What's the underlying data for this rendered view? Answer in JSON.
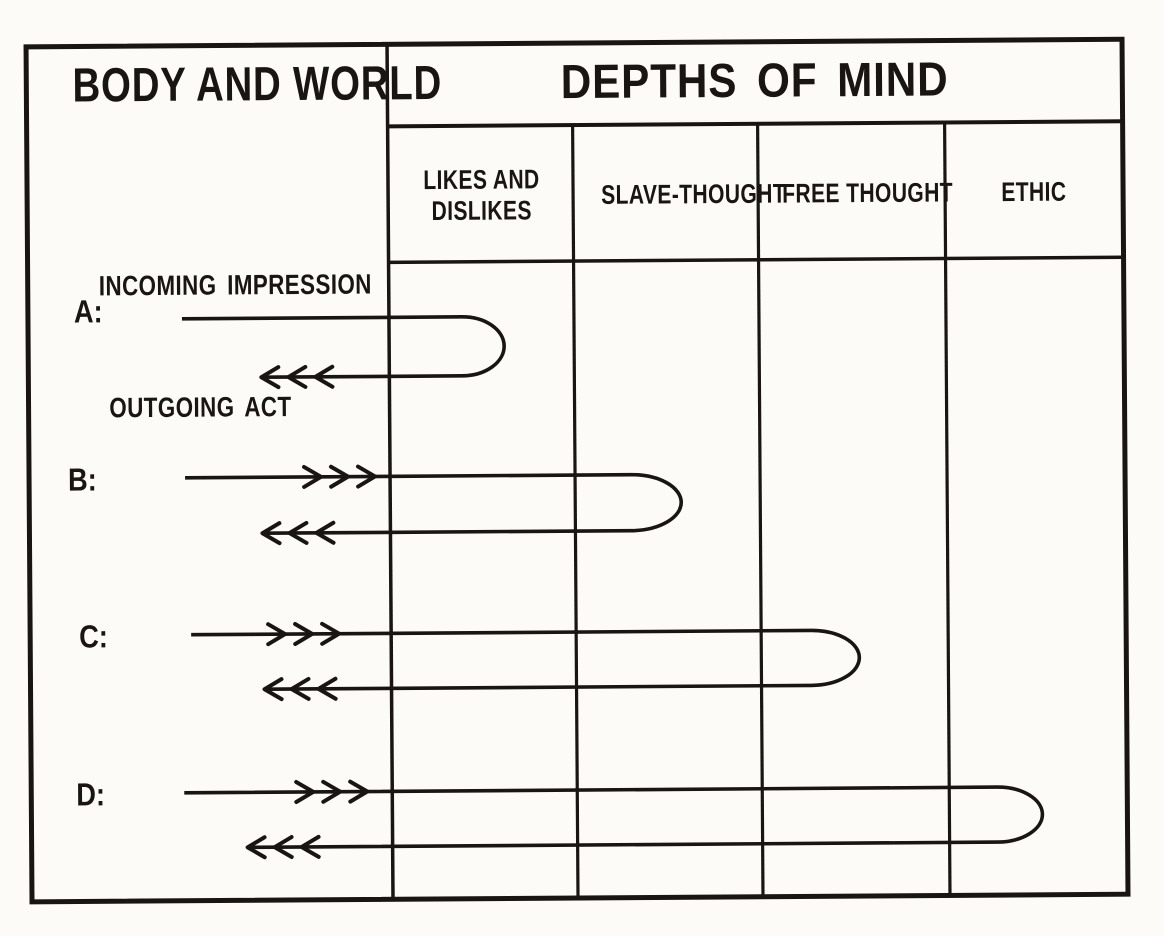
{
  "figure": {
    "left_panel_title": "BODY AND WORLD",
    "right_panel_title": "DEPTHS OF MIND",
    "columns": [
      {
        "label": "LIKES AND DISLIKES"
      },
      {
        "label": "SLAVE-THOUGHT"
      },
      {
        "label": "FREE THOUGHT"
      },
      {
        "label": "ETHIC"
      }
    ],
    "annotations": {
      "incoming": "INCOMING IMPRESSION",
      "outgoing": "OUTGOING ACT"
    },
    "rows": [
      {
        "label": "A:",
        "reaches_column": "LIKES AND DISLIKES",
        "incoming_arrowheads": 0,
        "outgoing_arrowheads": 3,
        "geom": {
          "y_in": 316,
          "y_out": 375,
          "x_start": 183,
          "x_loop": 505,
          "rx": 42,
          "x_return": 262,
          "chevron_in_tip": null,
          "chevron_out_tip": 262
        }
      },
      {
        "label": "B:",
        "reaches_column": "SLAVE-THOUGHT",
        "incoming_arrowheads": 3,
        "outgoing_arrowheads": 3,
        "geom": {
          "y_in": 475,
          "y_out": 531,
          "x_start": 185,
          "x_loop": 681,
          "rx": 50,
          "x_return": 262,
          "chevron_in_tip": 375,
          "chevron_out_tip": 262
        }
      },
      {
        "label": "C:",
        "reaches_column": "FREE THOUGHT",
        "incoming_arrowheads": 3,
        "outgoing_arrowheads": 3,
        "geom": {
          "y_in": 632,
          "y_out": 687,
          "x_start": 190,
          "x_loop": 858,
          "rx": 48,
          "x_return": 263,
          "chevron_in_tip": 338,
          "chevron_out_tip": 263
        }
      },
      {
        "label": "D:",
        "reaches_column": "ETHIC",
        "incoming_arrowheads": 3,
        "outgoing_arrowheads": 3,
        "geom": {
          "y_in": 790,
          "y_out": 845,
          "x_start": 182,
          "x_loop": 1040,
          "rx": 45,
          "x_return": 245,
          "chevron_in_tip": 365,
          "chevron_out_tip": 245
        }
      }
    ],
    "grid": {
      "frame": {
        "x": 29,
        "y": 43,
        "w": 1096,
        "h": 855
      },
      "divider_x": 390,
      "column_dividers_x": [
        575,
        760,
        947
      ],
      "header_rule_y": 125,
      "subheader_rule_y": 261
    },
    "colors": {
      "ink": "#181512",
      "paper": "#fcfbf8"
    }
  }
}
